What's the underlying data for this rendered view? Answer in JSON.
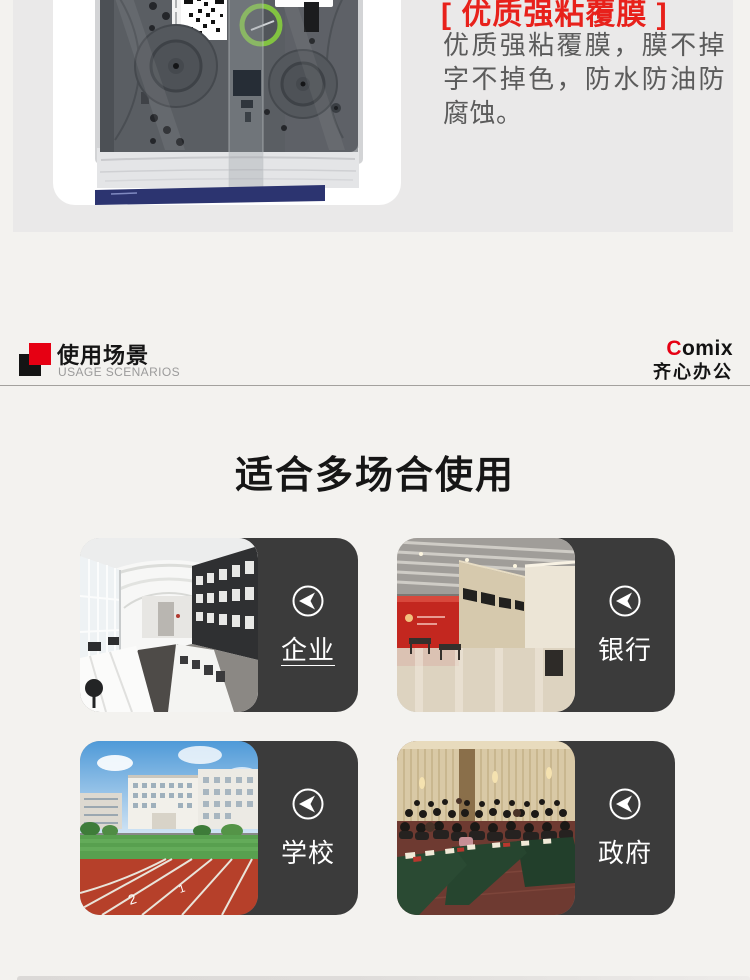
{
  "colors": {
    "accent_red": "#e8211b",
    "brand_red": "#e60013",
    "panel_dark": "#3b3b3b",
    "hero_bg": "#eae9e9",
    "page_bg": "#f3f2ef"
  },
  "hero": {
    "feature_title": "[ 优质强粘覆膜 ]",
    "feature_desc": "优质强粘覆膜，膜不掉字不掉色，防水防油防腐蚀。"
  },
  "section_header": {
    "title": "使用场景",
    "subtitle": "USAGE SCENARIOS",
    "brand_en_first": "C",
    "brand_en_rest": "omix",
    "brand_cn": "齐心办公"
  },
  "usage": {
    "heading": "适合多场合使用",
    "cards": [
      {
        "label": "企业",
        "scene": "office"
      },
      {
        "label": "银行",
        "scene": "bank"
      },
      {
        "label": "学校",
        "scene": "school"
      },
      {
        "label": "政府",
        "scene": "government"
      }
    ]
  }
}
